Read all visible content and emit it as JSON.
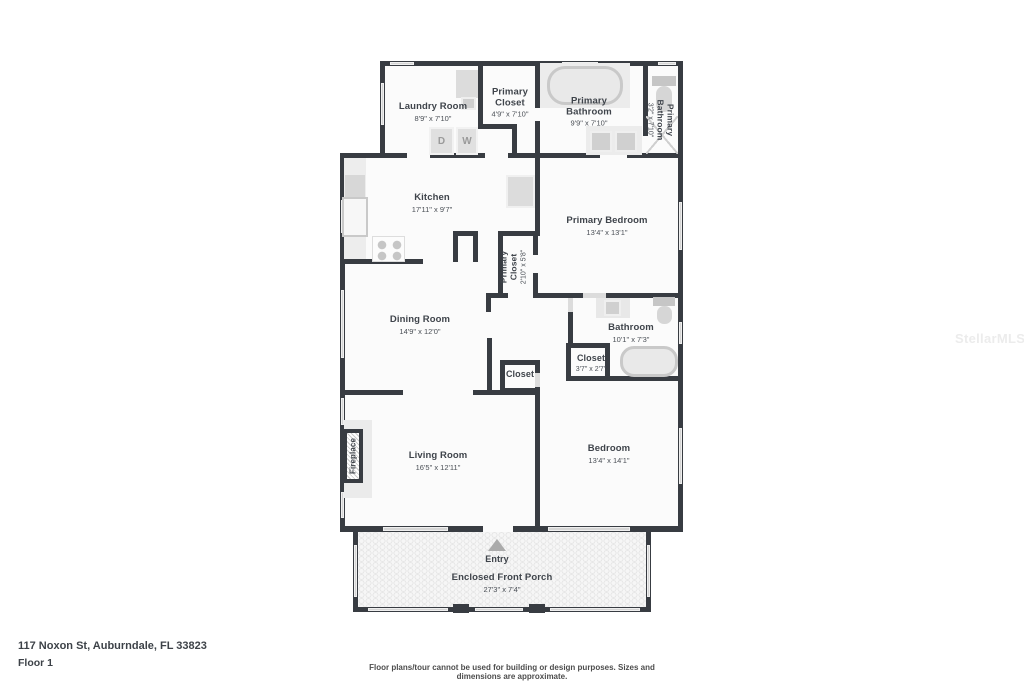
{
  "watermark": "StellarMLS",
  "footer": {
    "address": "117 Noxon St, Auburndale, FL 33823",
    "floor": "Floor 1",
    "disclaimer": "Floor plans/tour cannot be used for building or design purposes. Sizes and dimensions are approximate."
  },
  "rooms": {
    "laundry": {
      "name": "Laundry Room",
      "dims": "8'9\" x 7'10\""
    },
    "primary_closet": {
      "name": "Primary Closet",
      "dims": "4'9\" x 7'10\""
    },
    "primary_bathroom": {
      "name": "Primary Bathroom",
      "dims": "9'9\" x 7'10\""
    },
    "primary_wc": {
      "name": "Primary Bathroom",
      "dims": "3'2\" x 7'10\""
    },
    "kitchen": {
      "name": "Kitchen",
      "dims": "17'11\" x 9'7\""
    },
    "primary_bedroom": {
      "name": "Primary Bedroom",
      "dims": "13'4\" x 13'1\""
    },
    "hall_primary_closet": {
      "name": "Primary Closet",
      "dims": "2'10\" x 5'8\""
    },
    "dining": {
      "name": "Dining Room",
      "dims": "14'9\" x 12'0\""
    },
    "bathroom": {
      "name": "Bathroom",
      "dims": "10'1\" x 7'3\""
    },
    "closet_bath": {
      "name": "Closet",
      "dims": "3'7\" x 2'7\""
    },
    "closet_hall": {
      "name": "Closet"
    },
    "living": {
      "name": "Living Room",
      "dims": "16'5\" x 12'11\""
    },
    "bedroom": {
      "name": "Bedroom",
      "dims": "13'4\" x 14'1\""
    },
    "entry": {
      "name": "Entry"
    },
    "porch": {
      "name": "Enclosed Front Porch",
      "dims": "27'3\" x 7'4\""
    },
    "fireplace": {
      "name": "Fireplace"
    }
  },
  "appliances": {
    "dryer": "D",
    "washer": "W"
  },
  "colors": {
    "wall": "#383c42",
    "text": "#3f444b",
    "fixture": "#d9d9d9",
    "floor": "#fbfbfb"
  }
}
